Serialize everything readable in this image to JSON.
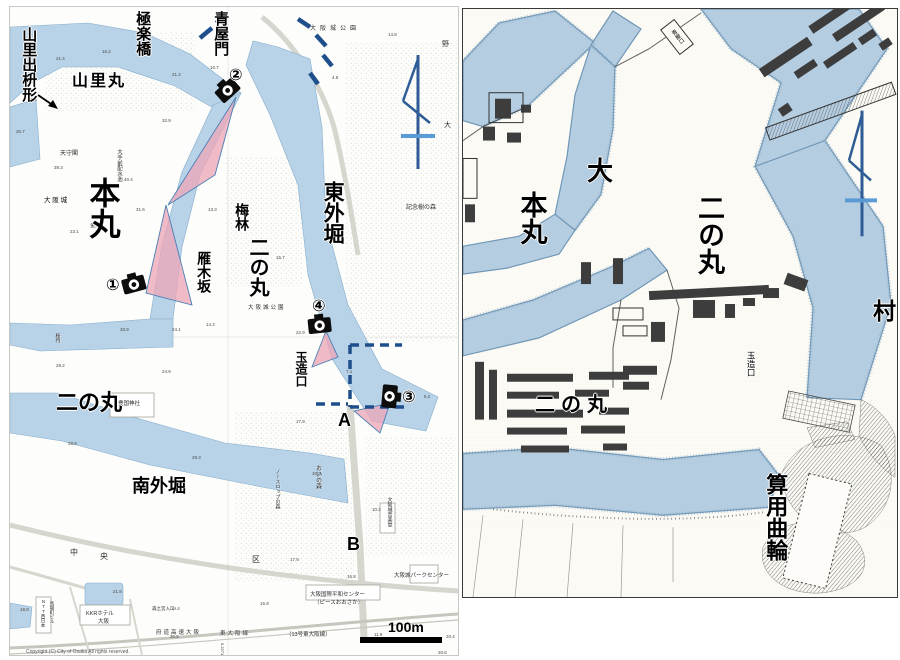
{
  "colors": {
    "water_modern": "#b8d2e7",
    "water_edge": "#86aecd",
    "cone_pink": "#eca6b8",
    "cone_edge": "#4a7fb5",
    "route_blue": "#1f4e8c",
    "arrow_dark": "#2e5c96",
    "arrow_light": "#5b9bd5",
    "water_hist": "#b5cde1",
    "building_dark": "#3d3d3d"
  },
  "left_map": {
    "labels": {
      "yamazato_demasugata": "山里出枡形",
      "gokurakubashi": "極楽橋",
      "yamazato_maru": "山里丸",
      "aoya_mon": "青屋門",
      "honmaru": "本丸",
      "osakajo_small": "大 阪 城",
      "higashi_sotobori": "東外堀",
      "bairin": "梅林",
      "ninomaru_center": "二の丸",
      "gangizaka": "雁木坂",
      "tamatsukuri_guchi": "玉造口",
      "ninomaru_south": "二の丸",
      "minami_sotobori": "南外堀",
      "point_a": "A",
      "point_b": "B"
    },
    "cameras": [
      {
        "number": "①"
      },
      {
        "number": "②"
      },
      {
        "number": "③"
      },
      {
        "number": "④"
      }
    ],
    "scale_label": "100m",
    "copyright": "Copyright (C) City of Osaka All rights reserved.",
    "tiny_labels": [
      {
        "t": "大阪城公園",
        "x": 300,
        "y": 19,
        "s": 6,
        "ls": 4
      },
      {
        "t": "野",
        "x": 432,
        "y": 34,
        "s": 7
      },
      {
        "t": "大",
        "x": 434,
        "y": 115,
        "s": 7
      },
      {
        "t": "記念樹の森",
        "x": 396,
        "y": 198,
        "s": 6
      },
      {
        "t": "天守閣",
        "x": 50,
        "y": 144,
        "s": 6
      },
      {
        "t": "大手前配水池",
        "x": 106,
        "y": 142,
        "s": 5.5,
        "v": 1
      },
      {
        "t": "金蔵",
        "x": 80,
        "y": 216,
        "s": 5.5
      },
      {
        "t": "大阪城公園",
        "x": 238,
        "y": 298,
        "s": 5.5,
        "ls": 2
      },
      {
        "t": "桜門",
        "x": 44,
        "y": 326,
        "s": 5,
        "v": 1
      },
      {
        "t": "豊国神社",
        "x": 108,
        "y": 394,
        "s": 5.5
      },
      {
        "t": "おいの森",
        "x": 304,
        "y": 458,
        "s": 6,
        "v": 1
      },
      {
        "t": "ノースロップの森",
        "x": 264,
        "y": 462,
        "s": 5,
        "v": 1
      },
      {
        "t": "大阪城音楽堂",
        "x": 376,
        "y": 490,
        "s": 5,
        "v": 1
      },
      {
        "t": "中",
        "x": 60,
        "y": 542,
        "s": 8
      },
      {
        "t": "央",
        "x": 90,
        "y": 546,
        "s": 8
      },
      {
        "t": "区",
        "x": 242,
        "y": 549,
        "s": 8
      },
      {
        "t": "大阪城パークセンター",
        "x": 384,
        "y": 566,
        "s": 5.5
      },
      {
        "t": "大阪国際平和センター",
        "x": 300,
        "y": 585,
        "s": 5.5
      },
      {
        "t": "（ピースおおさか）",
        "x": 304,
        "y": 593,
        "s": 5.5
      },
      {
        "t": "KKRホテル",
        "x": 76,
        "y": 604,
        "s": 5.5
      },
      {
        "t": "大阪",
        "x": 88,
        "y": 612,
        "s": 5.5
      },
      {
        "t": "NTT西日本",
        "x": 30,
        "y": 592,
        "s": 4.5,
        "v": 1
      },
      {
        "t": "馬場町ビル",
        "x": 39,
        "y": 594,
        "s": 4.5,
        "v": 1
      },
      {
        "t": "森之宮入口",
        "x": 142,
        "y": 600,
        "s": 4.5
      },
      {
        "t": "府道高速大阪",
        "x": 146,
        "y": 623,
        "s": 5.5,
        "ls": 2
      },
      {
        "t": "東大阪線",
        "x": 210,
        "y": 624,
        "s": 5.5,
        "ls": 2
      },
      {
        "t": "（13号東大阪線）",
        "x": 276,
        "y": 625,
        "s": 5.5
      },
      {
        "t": "5.2271",
        "x": 214,
        "y": 636,
        "s": 4,
        "r": 90
      }
    ],
    "spot_heights": [
      {
        "t": "21.4",
        "x": 46,
        "y": 49
      },
      {
        "t": "16.2",
        "x": 92,
        "y": 42
      },
      {
        "t": "26.3",
        "x": 18,
        "y": 90
      },
      {
        "t": "21.2",
        "x": 162,
        "y": 65
      },
      {
        "t": "10.7",
        "x": 200,
        "y": 58
      },
      {
        "t": "25.7",
        "x": 6,
        "y": 122
      },
      {
        "t": "32.9",
        "x": 152,
        "y": 111
      },
      {
        "t": "14.8",
        "x": 378,
        "y": 25
      },
      {
        "t": "4.5",
        "x": 322,
        "y": 68
      },
      {
        "t": "39.3",
        "x": 44,
        "y": 158
      },
      {
        "t": "40.4",
        "x": 114,
        "y": 170
      },
      {
        "t": "31.6",
        "x": 126,
        "y": 200
      },
      {
        "t": "13.3",
        "x": 198,
        "y": 200
      },
      {
        "t": "15.7",
        "x": 266,
        "y": 248
      },
      {
        "t": "23.1",
        "x": 60,
        "y": 222
      },
      {
        "t": "22.9",
        "x": 286,
        "y": 323
      },
      {
        "t": "14.2",
        "x": 196,
        "y": 315
      },
      {
        "t": "33.9",
        "x": 110,
        "y": 320
      },
      {
        "t": "24.1",
        "x": 162,
        "y": 320
      },
      {
        "t": "28.2",
        "x": 46,
        "y": 356
      },
      {
        "t": "7.1",
        "x": 336,
        "y": 362
      },
      {
        "t": "24.9",
        "x": 152,
        "y": 362
      },
      {
        "t": "5.2",
        "x": 414,
        "y": 387
      },
      {
        "t": "17.8",
        "x": 286,
        "y": 412
      },
      {
        "t": "28.9",
        "x": 58,
        "y": 434
      },
      {
        "t": "29.3",
        "x": 182,
        "y": 448
      },
      {
        "t": "10.3",
        "x": 302,
        "y": 464
      },
      {
        "t": "10.2",
        "x": 362,
        "y": 500
      },
      {
        "t": "17.9",
        "x": 280,
        "y": 550
      },
      {
        "t": "16.8",
        "x": 337,
        "y": 567
      },
      {
        "t": "18.8",
        "x": 10,
        "y": 600
      },
      {
        "t": "21.8",
        "x": 103,
        "y": 582
      },
      {
        "t": "19.4",
        "x": 161,
        "y": 599
      },
      {
        "t": "16.9",
        "x": 250,
        "y": 594
      },
      {
        "t": "30.5",
        "x": 160,
        "y": 627
      },
      {
        "t": "11.9",
        "x": 364,
        "y": 625
      },
      {
        "t": "20.4",
        "x": 436,
        "y": 627
      },
      {
        "t": "20.6",
        "x": 428,
        "y": 643
      }
    ]
  },
  "right_map": {
    "labels": {
      "dai": "大",
      "honmaru": "本丸",
      "ninomaru_east": "二の丸",
      "ninomaru_west": "二の丸",
      "tamatsukuri_guchi": "玉造口",
      "sanyo_kuruwa": "算用曲輪",
      "mura": "村",
      "aoya_guchi": "青屋口"
    }
  }
}
